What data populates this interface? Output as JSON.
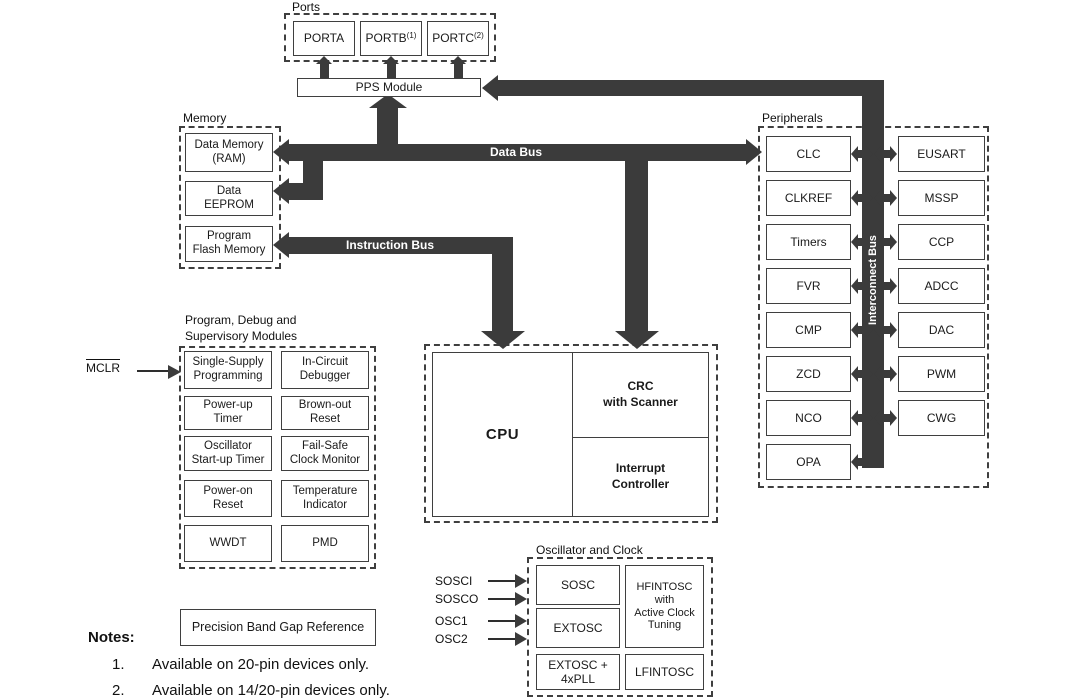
{
  "colors": {
    "bus": "#3b3b3b",
    "box_border": "#3f3f3f",
    "text": "#1a1a1a",
    "bus_text": "#ffffff",
    "background": "#ffffff"
  },
  "ports": {
    "label": "Ports",
    "items": [
      {
        "label": "PORTA",
        "sup": ""
      },
      {
        "label": "PORTB",
        "sup": "(1)"
      },
      {
        "label": "PORTC",
        "sup": "(2)"
      }
    ]
  },
  "pps": {
    "label": "PPS Module"
  },
  "buses": {
    "data": "Data Bus",
    "instruction": "Instruction Bus",
    "interconnect": "Interconnect Bus"
  },
  "memory": {
    "label": "Memory",
    "items": [
      "Data Memory\n(RAM)",
      "Data\nEEPROM",
      "Program\nFlash Memory"
    ]
  },
  "debug": {
    "label": "Program, Debug and\nSupervisory Modules",
    "items": [
      "Single-Supply\nProgramming",
      "In-Circuit\nDebugger",
      "Power-up\nTimer",
      "Brown-out\nReset",
      "Oscillator\nStart-up Timer",
      "Fail-Safe\nClock Monitor",
      "Power-on\nReset",
      "Temperature\nIndicator",
      "WWDT",
      "PMD"
    ]
  },
  "mclr": {
    "label": "MCLR"
  },
  "cpu": {
    "label": "CPU",
    "crc": "CRC\nwith Scanner",
    "interrupt": "Interrupt\nController"
  },
  "peripherals": {
    "label": "Peripherals",
    "left": [
      "CLC",
      "CLKREF",
      "Timers",
      "FVR",
      "CMP",
      "ZCD",
      "NCO",
      "OPA"
    ],
    "right": [
      "EUSART",
      "MSSP",
      "CCP",
      "ADCC",
      "DAC",
      "PWM",
      "CWG"
    ]
  },
  "oscillator": {
    "label": "Oscillator and Clock",
    "blocks": [
      "SOSC",
      "EXTOSC",
      "EXTOSC +\n4xPLL",
      "HFINTOSC\nwith\nActive Clock\nTuning",
      "LFINTOSC"
    ],
    "inputs": [
      "SOSCI",
      "SOSCO",
      "OSC1",
      "OSC2"
    ]
  },
  "bandgap": {
    "label": "Precision Band Gap Reference"
  },
  "notes": {
    "label": "Notes:",
    "items": [
      {
        "num": "1.",
        "text": "Available on 20-pin devices only."
      },
      {
        "num": "2.",
        "text": "Available on 14/20-pin devices only."
      }
    ]
  }
}
